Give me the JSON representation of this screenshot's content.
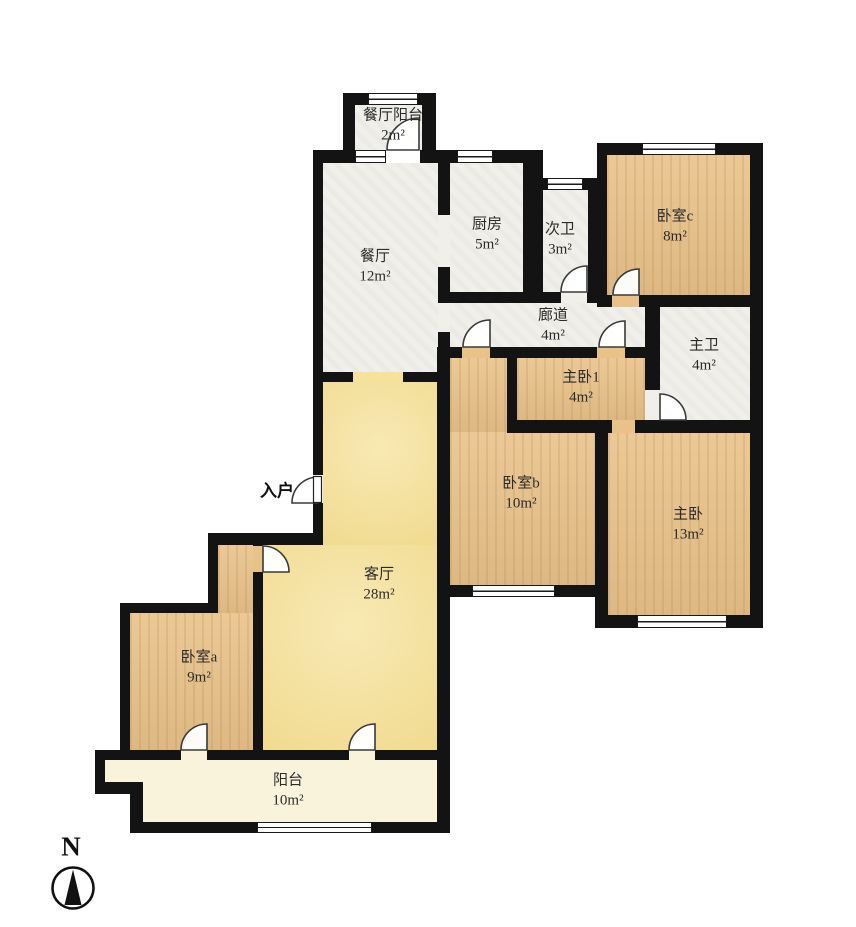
{
  "title": "户型图",
  "compass": {
    "label": "N"
  },
  "entrance": {
    "label": "入户"
  },
  "rooms": [
    {
      "id": "dining_balcony",
      "name": "餐厅阳台",
      "area": "2m²"
    },
    {
      "id": "dining",
      "name": "餐厅",
      "area": "12m²"
    },
    {
      "id": "kitchen",
      "name": "厨房",
      "area": "5m²"
    },
    {
      "id": "bath_secondary",
      "name": "次卫",
      "area": "3m²"
    },
    {
      "id": "bedroom_c",
      "name": "卧室c",
      "area": "8m²"
    },
    {
      "id": "corridor",
      "name": "廊道",
      "area": "4m²"
    },
    {
      "id": "bath_master",
      "name": "主卫",
      "area": "4m²"
    },
    {
      "id": "master_bedroom_1",
      "name": "主卧1",
      "area": "4m²"
    },
    {
      "id": "bedroom_b",
      "name": "卧室b",
      "area": "10m²"
    },
    {
      "id": "master_bedroom",
      "name": "主卧",
      "area": "13m²"
    },
    {
      "id": "living",
      "name": "客厅",
      "area": "28m²"
    },
    {
      "id": "bedroom_a",
      "name": "卧室a",
      "area": "9m²"
    },
    {
      "id": "balcony",
      "name": "阳台",
      "area": "10m²"
    }
  ],
  "colors": {
    "wall": "#131313",
    "wood_floor": "#e9c289",
    "tile_floor": "#f1efea",
    "living_floor": "#f6e29b",
    "balcony_floor": "#f8f3da"
  }
}
